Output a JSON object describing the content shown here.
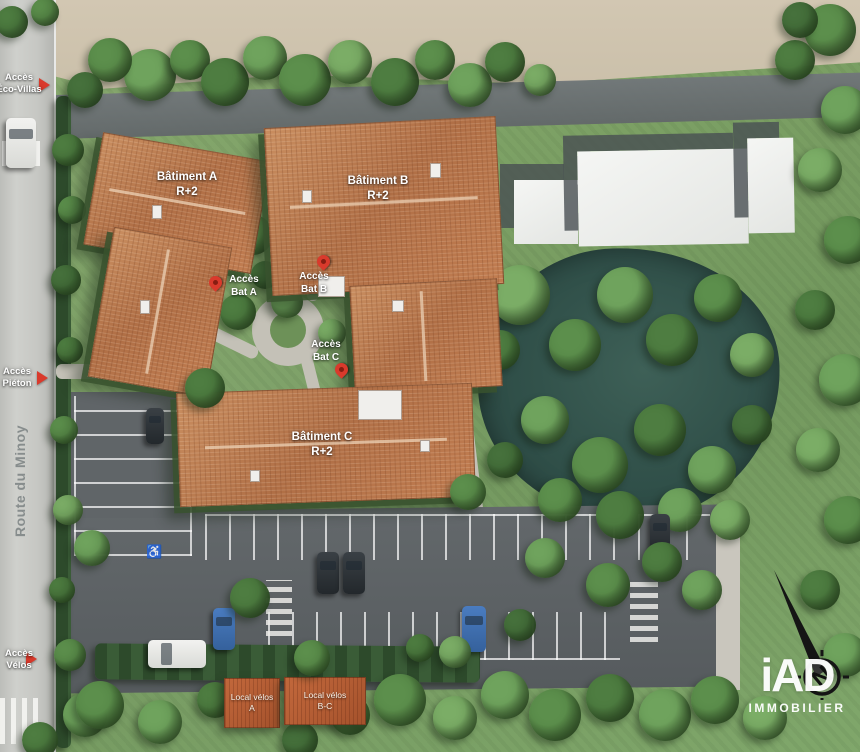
{
  "plan": {
    "street_name": "Route du Minoy",
    "buildings": [
      {
        "name": "Bâtiment A",
        "floors": "R+2"
      },
      {
        "name": "Bâtiment B",
        "floors": "R+2"
      },
      {
        "name": "Bâtiment C",
        "floors": "R+2"
      }
    ],
    "building_access": [
      {
        "line1": "Accès",
        "line2": "Bat A"
      },
      {
        "line1": "Accès",
        "line2": "Bat B"
      },
      {
        "line1": "Accès",
        "line2": "Bat C"
      }
    ],
    "site_access": [
      {
        "line1": "Accès",
        "line2": "Éco-Villas"
      },
      {
        "line1": "Accès",
        "line2": "Piéton"
      },
      {
        "line1": "Accès",
        "line2": "Vélos"
      }
    ],
    "bike_sheds": [
      {
        "line1": "Local vélos",
        "line2": "A"
      },
      {
        "line1": "Local vélos",
        "line2": "B-C"
      }
    ],
    "branding": {
      "logo_text": "iAD",
      "logo_subtitle": "IMMOBILIER"
    },
    "compass_north": "N",
    "markings": {
      "accessible_parking_icon": "♿"
    },
    "colors": {
      "roof_tile": "#b97a50",
      "water": "#33534b",
      "asphalt": "#5d6264",
      "road": "#c7c8c4",
      "grass": "#7ba065",
      "pin_red": "#d93a2c",
      "logo_white": "#ffffff"
    }
  }
}
